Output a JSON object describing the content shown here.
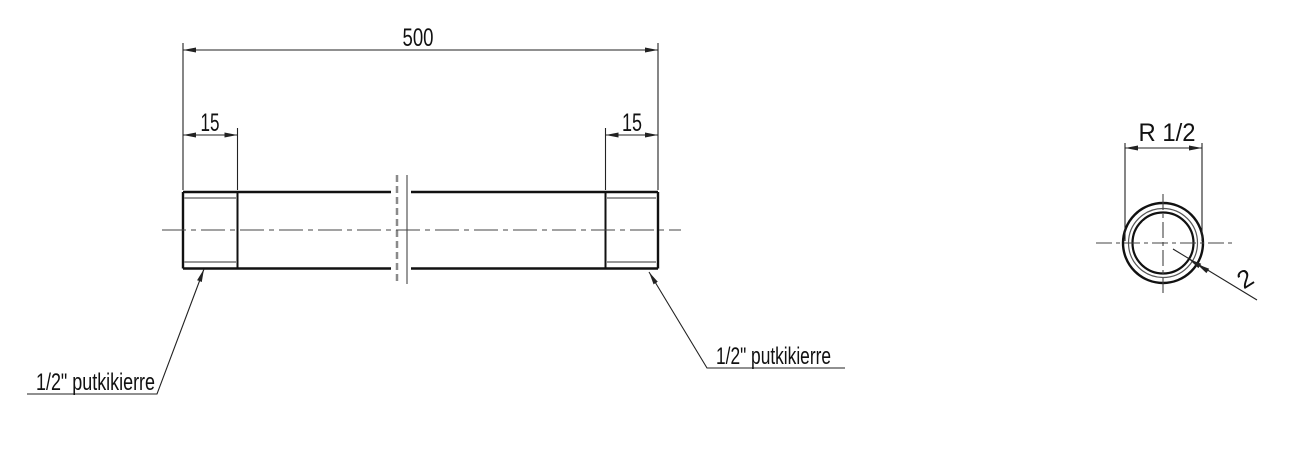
{
  "drawing": {
    "side_view": {
      "overall_length": "500",
      "thread_length_left": "15",
      "thread_length_right": "15",
      "thread_label_left": "1/2\" putkikierre",
      "thread_label_right": "1/2\" putkikierre"
    },
    "section_view": {
      "thread_size": "R 1/2",
      "wall_thickness": "2"
    },
    "colors": {
      "main_line": "#111111",
      "thin_line": "#8a8a8a",
      "centerline": "#444444",
      "dimension_line": "#222222",
      "background": "#ffffff"
    }
  }
}
